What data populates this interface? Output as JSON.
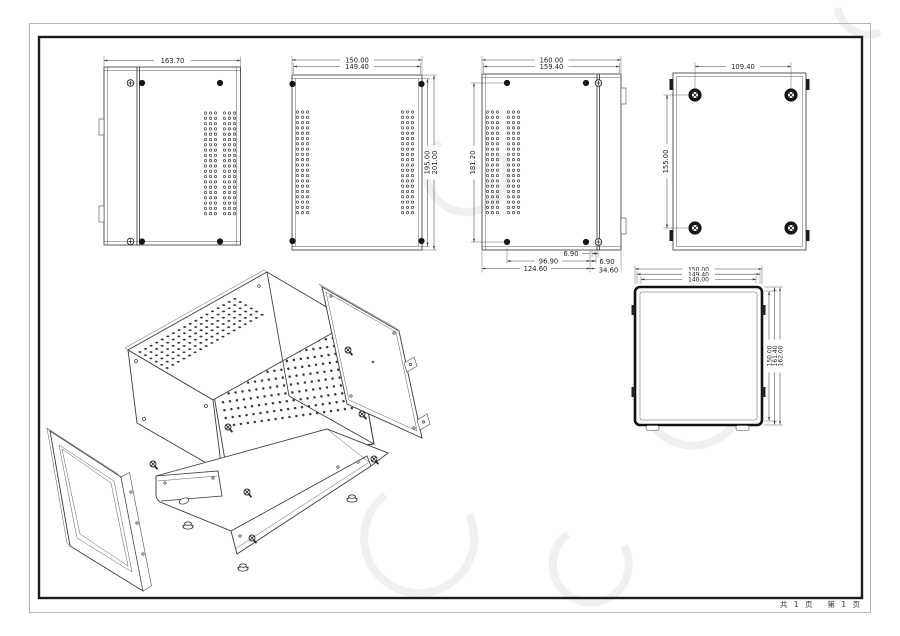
{
  "sheet": {
    "footer": {
      "total_pages": "共 1 页",
      "current_page": "第 1 页"
    }
  },
  "views": {
    "side_left": {
      "width": "163.70"
    },
    "front": {
      "width_outer": "150.00",
      "width_inner": "149.40",
      "height_inner": "195.00",
      "height_outer": "201.00"
    },
    "side_right": {
      "width_outer": "160.00",
      "width_inner": "159.40",
      "height": "181.20",
      "offset_a": "6.90",
      "span": "96.90",
      "total_left": "124.60",
      "offset_b": "6.90",
      "total_right": "34.60"
    },
    "bottom": {
      "feet_spacing_x": "109.40",
      "feet_spacing_y": "155.00"
    },
    "top": {
      "widths": [
        "150.00",
        "149.40",
        "140.00"
      ],
      "depths": [
        "150.00",
        "161.40",
        "162.00"
      ]
    }
  }
}
